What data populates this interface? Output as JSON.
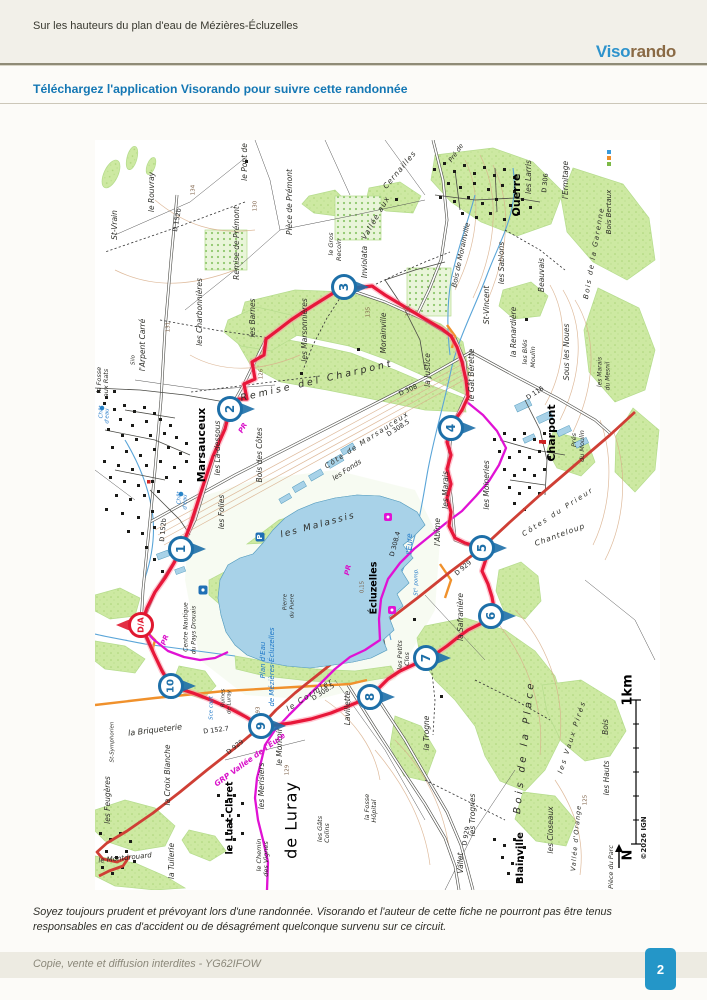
{
  "page": {
    "header_title": "Sur les hauteurs du plan d'eau de Mézières-Écluzelles",
    "logo": {
      "viso": "Viso",
      "rando": "rando"
    },
    "download_link": "Téléchargez l'application Visorando pour suivre cette randonnée",
    "disclaimer": "Soyez toujours prudent et prévoyant lors d'une randonnée. Visorando et l'auteur de cette fiche ne pourront pas être tenus responsables en cas d'accident ou de désagrément quelconque survenu sur ce circuit.",
    "footer_note": "Copie, vente et diffusion interdites - YG62IFOW",
    "page_number": "2"
  },
  "map": {
    "accent_colors": {
      "route_red": "#e8173a",
      "gr_magenta": "#e012d4",
      "waypoint_blue": "#1d6fa8",
      "water_blue": "#a8d2e8",
      "wood_green": "#cde9a2"
    },
    "start_marker": {
      "label": "D/A",
      "x": 46,
      "y": 485
    },
    "waypoints": [
      {
        "n": "1",
        "x": 86,
        "y": 409
      },
      {
        "n": "2",
        "x": 135,
        "y": 269
      },
      {
        "n": "3",
        "x": 249,
        "y": 147
      },
      {
        "n": "4",
        "x": 356,
        "y": 288
      },
      {
        "n": "5",
        "x": 387,
        "y": 408
      },
      {
        "n": "6",
        "x": 396,
        "y": 476
      },
      {
        "n": "7",
        "x": 331,
        "y": 518
      },
      {
        "n": "8",
        "x": 275,
        "y": 557
      },
      {
        "n": "9",
        "x": 166,
        "y": 586
      },
      {
        "n": "10",
        "x": 76,
        "y": 546
      }
    ],
    "icons": [
      {
        "type": "parking",
        "x": 165,
        "y": 397
      },
      {
        "type": "poi",
        "x": 293,
        "y": 377
      },
      {
        "type": "poi",
        "x": 297,
        "y": 470
      },
      {
        "type": "info",
        "x": 108,
        "y": 450
      },
      {
        "type": "watertower",
        "x": 7,
        "y": 268
      },
      {
        "type": "watertower",
        "x": 86,
        "y": 354
      },
      {
        "type": "church",
        "x": 449,
        "y": 302
      }
    ],
    "labels": [
      {
        "t": "Marsauceux",
        "x": 107,
        "y": 305,
        "s": 11,
        "c": "ville"
      },
      {
        "t": "Ouerre",
        "x": 422,
        "y": 55,
        "s": 11,
        "c": "ville"
      },
      {
        "t": "Charpont",
        "x": 457,
        "y": 293,
        "s": 11,
        "c": "ville"
      },
      {
        "t": "Écluzelles",
        "x": 279,
        "y": 448,
        "s": 9.5,
        "c": "ville"
      },
      {
        "t": "Blainville",
        "x": 425,
        "y": 718,
        "s": 10,
        "c": "ville"
      },
      {
        "t": "le Luat-Claret",
        "x": 135,
        "y": 678,
        "s": 9.5,
        "c": "ville"
      },
      {
        "t": "de Luray",
        "x": 197,
        "y": 680,
        "s": 16,
        "c": "big"
      },
      {
        "t": "St-Vrain",
        "x": 20,
        "y": 85
      },
      {
        "t": "le Rouvray",
        "x": 57,
        "y": 52
      },
      {
        "t": "l'Arpent Carré",
        "x": 48,
        "y": 205
      },
      {
        "t": "la Fosse",
        "x": 4,
        "y": 240,
        "s": 6.5
      },
      {
        "t": "aux Rats",
        "x": 11,
        "y": 243,
        "s": 6.5
      },
      {
        "t": "Silo",
        "x": 38,
        "y": 220,
        "s": 5.5
      },
      {
        "t": "les Charbonnières",
        "x": 105,
        "y": 172
      },
      {
        "t": "Remise de Prémont",
        "x": 142,
        "y": 103
      },
      {
        "t": "Pièce de Prémont",
        "x": 195,
        "y": 62
      },
      {
        "t": "le Pont de",
        "x": 150,
        "y": 22
      },
      {
        "t": "les Barnes",
        "x": 158,
        "y": 178
      },
      {
        "t": "les Marsonnières",
        "x": 210,
        "y": 190
      },
      {
        "t": "le Gros",
        "x": 236,
        "y": 104,
        "s": 6.5
      },
      {
        "t": "Recoin",
        "x": 244,
        "y": 110,
        "s": 6.5
      },
      {
        "t": "Morainville",
        "x": 289,
        "y": 193
      },
      {
        "t": "Inviolata",
        "x": 270,
        "y": 122
      },
      {
        "t": "Bois de Morainville",
        "x": 366,
        "y": 115,
        "r": -78,
        "s": 7
      },
      {
        "t": "le Gât Bérette",
        "x": 377,
        "y": 235
      },
      {
        "t": "la Justice",
        "x": 333,
        "y": 230
      },
      {
        "t": "St-Vincent",
        "x": 392,
        "y": 165
      },
      {
        "t": "les Sablons",
        "x": 407,
        "y": 123
      },
      {
        "t": "Beauvais",
        "x": 447,
        "y": 135
      },
      {
        "t": "la Renardière",
        "x": 419,
        "y": 192
      },
      {
        "t": "les Blés",
        "x": 430,
        "y": 212,
        "s": 6.5
      },
      {
        "t": "Moulin",
        "x": 438,
        "y": 217,
        "s": 6.5
      },
      {
        "t": "les Larris",
        "x": 434,
        "y": 37
      },
      {
        "t": "l'Ermitage",
        "x": 471,
        "y": 40
      },
      {
        "t": "Bois Bertaux",
        "x": 514,
        "y": 72,
        "s": 7
      },
      {
        "t": "Bois de la Garenne",
        "x": 499,
        "y": 113,
        "r": -80,
        "s": 7,
        "ls": 1.5
      },
      {
        "t": "Sous les Noues",
        "x": 472,
        "y": 212
      },
      {
        "t": "les Marais",
        "x": 505,
        "y": 232,
        "s": 6
      },
      {
        "t": "du Mesnil",
        "x": 513,
        "y": 236,
        "s": 6
      },
      {
        "t": "les Marais",
        "x": 351,
        "y": 350
      },
      {
        "t": "les Moineries",
        "x": 392,
        "y": 345
      },
      {
        "t": "Prés",
        "x": 479,
        "y": 300,
        "s": 6.5
      },
      {
        "t": "du Moulin",
        "x": 487,
        "y": 306,
        "s": 6.5
      },
      {
        "t": "l'Abîme",
        "x": 343,
        "y": 392
      },
      {
        "t": "la Safranière",
        "x": 366,
        "y": 477
      },
      {
        "t": "les Malassis",
        "x": 223,
        "y": 385,
        "r": -15,
        "s": 9,
        "ls": 2
      },
      {
        "t": "Pierre",
        "x": 190,
        "y": 462,
        "s": 5.5
      },
      {
        "t": "du Puere",
        "x": 197,
        "y": 466,
        "s": 5.5
      },
      {
        "t": "les Là-dessous",
        "x": 123,
        "y": 308
      },
      {
        "t": "Bois des Côtes",
        "x": 165,
        "y": 315
      },
      {
        "t": "les Folies",
        "x": 127,
        "y": 372
      },
      {
        "t": "les Petits",
        "x": 305,
        "y": 515,
        "s": 6.5
      },
      {
        "t": "Clos",
        "x": 312,
        "y": 519,
        "s": 6.5
      },
      {
        "t": "la Trogne",
        "x": 332,
        "y": 593
      },
      {
        "t": "Bois de la Place",
        "x": 429,
        "y": 607,
        "r": -84,
        "s": 10,
        "ls": 3.5
      },
      {
        "t": "les Vaux Pirés",
        "x": 477,
        "y": 597,
        "r": -72,
        "s": 7,
        "ls": 2
      },
      {
        "t": "Bois",
        "x": 511,
        "y": 587
      },
      {
        "t": "les Hauts",
        "x": 512,
        "y": 638
      },
      {
        "t": "Vallée d'Orange",
        "x": 481,
        "y": 698,
        "r": -85,
        "s": 6.5,
        "ls": 1
      },
      {
        "t": "les Closeaux",
        "x": 456,
        "y": 690
      },
      {
        "t": "les Trognes",
        "x": 378,
        "y": 675
      },
      {
        "t": "Vallet",
        "x": 366,
        "y": 723
      },
      {
        "t": "Pièce du Parc",
        "x": 516,
        "y": 727,
        "s": 6.5
      },
      {
        "t": "Lavillette",
        "x": 253,
        "y": 568
      },
      {
        "t": "le Montoir",
        "x": 185,
        "y": 607
      },
      {
        "t": "les Merisiers",
        "x": 167,
        "y": 646
      },
      {
        "t": "la Croix Blanche",
        "x": 73,
        "y": 635
      },
      {
        "t": "les Feugères",
        "x": 13,
        "y": 660
      },
      {
        "t": "les Gâts",
        "x": 225,
        "y": 689,
        "s": 6.5
      },
      {
        "t": "Colins",
        "x": 232,
        "y": 693,
        "s": 6.5
      },
      {
        "t": "la Fosse",
        "x": 272,
        "y": 667,
        "s": 6.5
      },
      {
        "t": "Hôpital",
        "x": 279,
        "y": 671,
        "s": 6.5
      },
      {
        "t": "le Chemin",
        "x": 164,
        "y": 715,
        "s": 6.5
      },
      {
        "t": "des Vignes",
        "x": 171,
        "y": 719,
        "s": 6.5
      },
      {
        "t": "la Tuilerie",
        "x": 77,
        "y": 721
      },
      {
        "t": "le Montdrouard",
        "x": 30,
        "y": 718,
        "r": -6,
        "s": 7
      },
      {
        "t": "Ruines",
        "x": 128,
        "y": 558,
        "s": 5.5
      },
      {
        "t": "de Luray",
        "x": 134,
        "y": 562,
        "s": 5.5
      },
      {
        "t": "la Briqueterie",
        "x": 60,
        "y": 590,
        "r": -7,
        "s": 8
      },
      {
        "t": "le Cormier",
        "x": 215,
        "y": 555,
        "r": -33,
        "ls": 1.5
      },
      {
        "t": "Remise del Charpont",
        "x": 222,
        "y": 241,
        "r": -13,
        "s": 9.5,
        "ls": 3
      },
      {
        "t": "Côte de Marsauceux",
        "x": 272,
        "y": 300,
        "r": -33,
        "s": 7,
        "ls": 1.5
      },
      {
        "t": "les Fonds",
        "x": 252,
        "y": 330,
        "r": -33,
        "s": 7
      },
      {
        "t": "Chanteloup",
        "x": 465,
        "y": 395,
        "r": -20,
        "ls": 1
      },
      {
        "t": "Côtes du Prieur",
        "x": 463,
        "y": 372,
        "r": -33,
        "ls": 2,
        "s": 7
      },
      {
        "t": "St-Symphorien",
        "x": 17,
        "y": 602,
        "s": 5.5
      },
      {
        "t": "Cernailles",
        "x": 305,
        "y": 30,
        "r": -50,
        "ls": 1
      },
      {
        "t": "Vallée aux",
        "x": 281,
        "y": 78,
        "r": -60,
        "ls": 1
      },
      {
        "t": "Pré de",
        "x": 361,
        "y": 13,
        "r": -55,
        "s": 6.5
      },
      {
        "t": "l'Eure",
        "x": 315,
        "y": 404,
        "c": "hydro",
        "s": 7.5
      },
      {
        "t": "Plan d'Eau",
        "x": 168,
        "y": 520,
        "c": "hydro",
        "s": 7
      },
      {
        "t": "de Mézières-Écluzelles",
        "x": 177,
        "y": 527,
        "c": "hydro",
        "s": 7
      },
      {
        "t": "Chât",
        "x": 6,
        "y": 272,
        "c": "hydro",
        "s": 5.5
      },
      {
        "t": "d'eau",
        "x": 12,
        "y": 276,
        "c": "hydro",
        "s": 5.5
      },
      {
        "t": "Chât",
        "x": 84,
        "y": 358,
        "c": "hydro",
        "s": 5.5
      },
      {
        "t": "d'eau",
        "x": 90,
        "y": 362,
        "c": "hydro",
        "s": 5.5
      },
      {
        "t": "Sce capt",
        "x": 116,
        "y": 568,
        "c": "hydro",
        "s": 5.5
      },
      {
        "t": "St° pomp.",
        "x": 321,
        "y": 442,
        "c": "hydro",
        "s": 5.5
      },
      {
        "t": "Centre Nautique",
        "x": 91,
        "y": 487,
        "s": 6
      },
      {
        "t": "du Pays Drouais",
        "x": 99,
        "y": 490,
        "s": 6
      },
      {
        "t": "D 152b",
        "x": 82,
        "y": 80,
        "r": -80,
        "s": 6.5,
        "c": "road"
      },
      {
        "t": "D 152b",
        "x": 68,
        "y": 390,
        "r": -85,
        "s": 6.5,
        "c": "road"
      },
      {
        "t": "D 308",
        "x": 313,
        "y": 250,
        "r": -25,
        "s": 6.5,
        "c": "road"
      },
      {
        "t": "D 308.5",
        "x": 303,
        "y": 288,
        "r": -33,
        "s": 6.5,
        "c": "road"
      },
      {
        "t": "D 116",
        "x": 440,
        "y": 253,
        "r": -33,
        "s": 6.5,
        "c": "road"
      },
      {
        "t": "D 306",
        "x": 450,
        "y": 43,
        "r": -85,
        "s": 6.5,
        "c": "road"
      },
      {
        "t": "D 929",
        "x": 368,
        "y": 428,
        "r": -40,
        "s": 6.5,
        "c": "road"
      },
      {
        "t": "D 929",
        "x": 140,
        "y": 607,
        "r": -38,
        "s": 6.5,
        "c": "road"
      },
      {
        "t": "D 929",
        "x": 371,
        "y": 696,
        "r": -80,
        "s": 6.5,
        "c": "road"
      },
      {
        "t": "D 152.7",
        "x": 121,
        "y": 590,
        "r": -7,
        "s": 6.5,
        "c": "road"
      },
      {
        "t": "D 308.5",
        "x": 228,
        "y": 552,
        "r": -33,
        "s": 6.5,
        "c": "road"
      },
      {
        "t": "D 308.4",
        "x": 300,
        "y": 404,
        "r": -75,
        "s": 6.5,
        "c": "road"
      },
      {
        "t": "131",
        "x": 73,
        "y": 187,
        "c": "elev",
        "s": 5.5
      },
      {
        "t": "134",
        "x": 98,
        "y": 50,
        "c": "elev",
        "s": 5.5
      },
      {
        "t": "130",
        "x": 160,
        "y": 66,
        "c": "elev",
        "s": 5.5
      },
      {
        "t": "126",
        "x": 166,
        "y": 234,
        "c": "elev",
        "s": 5.5
      },
      {
        "t": "135",
        "x": 273,
        "y": 172,
        "c": "elev",
        "s": 5.5
      },
      {
        "t": "133",
        "x": 313,
        "y": 171,
        "c": "elev",
        "s": 5.5
      },
      {
        "t": "121",
        "x": 130,
        "y": 262,
        "c": "elev",
        "s": 5.5
      },
      {
        "t": "93",
        "x": 163,
        "y": 570,
        "c": "elev",
        "s": 5.5
      },
      {
        "t": "129",
        "x": 192,
        "y": 630,
        "c": "elev",
        "s": 5.5
      },
      {
        "t": "125",
        "x": 490,
        "y": 660,
        "c": "elev",
        "s": 5.5
      },
      {
        "t": "0,15",
        "x": 267,
        "y": 447,
        "c": "elev",
        "s": 5.5
      },
      {
        "t": "PR",
        "x": 148,
        "y": 288,
        "r": -60,
        "s": 7,
        "c": "pr"
      },
      {
        "t": "PR",
        "x": 253,
        "y": 430,
        "r": -78,
        "s": 7,
        "c": "pr"
      },
      {
        "t": "PR",
        "x": 70,
        "y": 500,
        "r": -70,
        "s": 7,
        "c": "pr"
      },
      {
        "t": "GRP Vallée de l'Eure",
        "x": 155,
        "y": 620,
        "r": -36,
        "s": 7.5,
        "c": "pr"
      },
      {
        "t": "1km",
        "x": 533,
        "y": 550,
        "r": -90,
        "s": 13,
        "c": "scale"
      },
      {
        "t": "N",
        "x": 533,
        "y": 715,
        "r": -90,
        "s": 13,
        "c": "scale"
      },
      {
        "t": "©2026 IGN",
        "x": 549,
        "y": 698,
        "r": -90,
        "s": 7,
        "c": "ign"
      }
    ]
  }
}
